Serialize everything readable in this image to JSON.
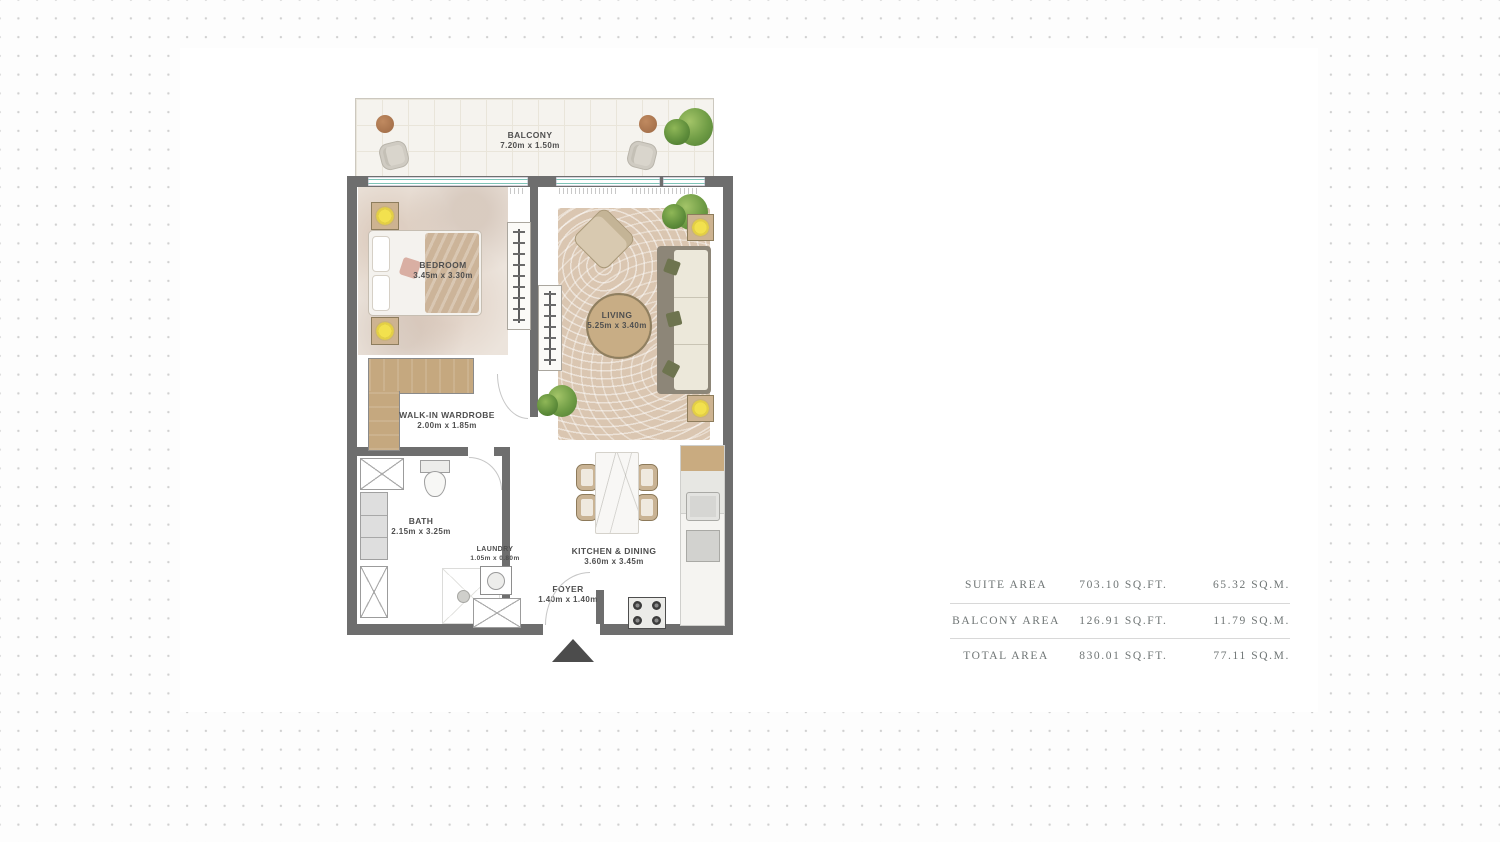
{
  "plan": {
    "balcony": {
      "name": "BALCONY",
      "dims": "7.20m x 1.50m"
    },
    "bedroom": {
      "name": "BEDROOM",
      "dims": "3.45m x 3.30m"
    },
    "living": {
      "name": "LIVING",
      "dims": "5.25m x 3.40m"
    },
    "wardrobe": {
      "name": "WALK-IN WARDROBE",
      "dims": "2.00m x 1.85m"
    },
    "bath": {
      "name": "BATH",
      "dims": "2.15m x 3.25m"
    },
    "laundry": {
      "name": "LAUNDRY",
      "dims": "1.05m x 0.80m"
    },
    "foyer": {
      "name": "FOYER",
      "dims": "1.40m x 1.40m"
    },
    "kitchen": {
      "name": "KITCHEN & DINING",
      "dims": "3.60m x 3.45m"
    }
  },
  "area_table": {
    "rows": [
      {
        "label": "SUITE AREA",
        "sqft": "703.10 SQ.FT.",
        "sqm": "65.32 SQ.M."
      },
      {
        "label": "BALCONY AREA",
        "sqft": "126.91 SQ.FT.",
        "sqm": "11.79 SQ.M."
      },
      {
        "label": "TOTAL AREA",
        "sqft": "830.01 SQ.FT.",
        "sqm": "77.11 SQ.M."
      }
    ]
  },
  "colors": {
    "wall": "#6e6e6e",
    "wood": "#c5a87f",
    "window_glass": "#7fc4b8",
    "lamp": "#f2e14e",
    "entry_arrow": "#4c4c4c",
    "rug": "#dac6b1",
    "dot_grid": "#d0d0d0"
  }
}
